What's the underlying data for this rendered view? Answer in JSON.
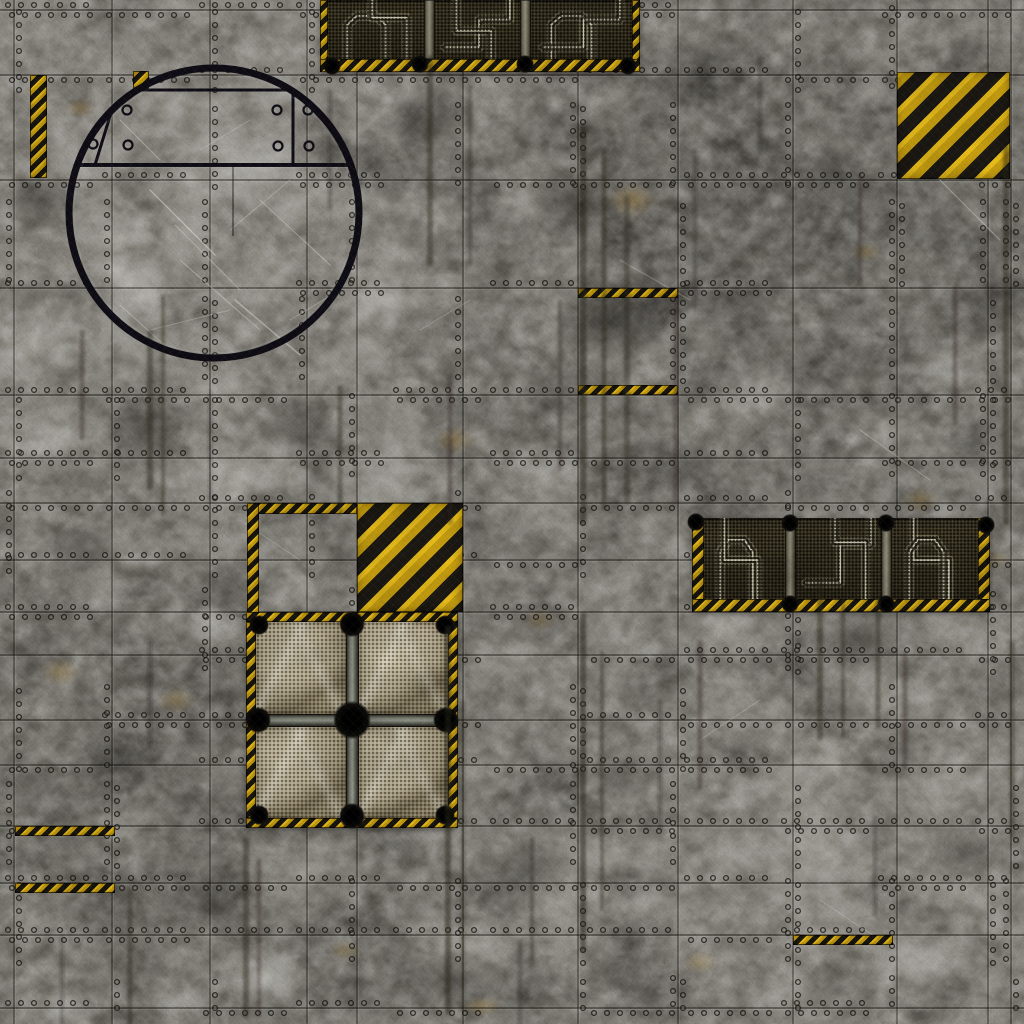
{
  "scene": {
    "type": "sci-fi-industrial-floor-battle-mat",
    "size": 1024
  },
  "palette": {
    "floor_mid": "#8e8b83",
    "floor_light": "#cbc8c0",
    "floor_dark": "#403e39",
    "seam": "#14120e",
    "seam_highlight": "rgba(255,255,255,0.13)",
    "rivet_fill": "rgba(180,177,168,0.15)",
    "rivet_ring": "#0f0d0a",
    "hazard_yellow_bright": "#f0bd17",
    "hazard_yellow": "#c9990e",
    "hazard_black": "#191611",
    "vent_bg_light": "#3a3420",
    "vent_bg_dark": "#201b10",
    "pipe_halo": "rgba(225,218,185,0.25)",
    "pipe_dark": "rgba(26,22,12,0.85)",
    "pipe_bright": "rgba(236,230,200,0.85)",
    "mesh_tan_light": "#d2c8ab",
    "mesh_tan": "#b5aa8d",
    "mesh_tan_dark": "#6f654d",
    "metal_bar_light": "#8d897a",
    "metal_bar_dark": "#17140c",
    "blob_black": "#0a0907",
    "hatch_ring": "#0d0b13",
    "scratch": "#efede6",
    "streak": "#262218",
    "rust": "#966e1e"
  },
  "seams": {
    "verticals": [
      14,
      112,
      210,
      307,
      357,
      463,
      578,
      678,
      793,
      897,
      988,
      1011
    ],
    "horizontals": [
      10,
      75,
      180,
      288,
      395,
      458,
      503,
      560,
      612,
      655,
      720,
      765,
      826,
      883,
      935,
      1008
    ]
  },
  "rivet_params": {
    "seed": 99,
    "step": 13,
    "radius": 2.4,
    "block": 97,
    "prob_h": 0.45,
    "prob_v": 0.32
  },
  "streaks": [
    [
      150,
      330,
      160,
      6,
      0.45
    ],
    [
      163,
      295,
      220,
      4,
      0.4
    ],
    [
      82,
      330,
      110,
      5,
      0.35
    ],
    [
      340,
      385,
      130,
      5,
      0.4
    ],
    [
      430,
      55,
      210,
      6,
      0.45
    ],
    [
      470,
      85,
      180,
      4,
      0.35
    ],
    [
      583,
      125,
      400,
      7,
      0.5
    ],
    [
      604,
      150,
      360,
      5,
      0.45
    ],
    [
      627,
      195,
      310,
      6,
      0.4
    ],
    [
      560,
      300,
      170,
      4,
      0.35
    ],
    [
      450,
      375,
      150,
      5,
      0.35
    ],
    [
      448,
      625,
      390,
      6,
      0.5
    ],
    [
      463,
      700,
      310,
      4,
      0.4
    ],
    [
      583,
      612,
      340,
      6,
      0.5
    ],
    [
      602,
      650,
      260,
      4,
      0.4
    ],
    [
      700,
      640,
      150,
      5,
      0.35
    ],
    [
      820,
      580,
      160,
      6,
      0.45
    ],
    [
      843,
      598,
      140,
      4,
      0.4
    ],
    [
      878,
      598,
      130,
      5,
      0.4
    ],
    [
      955,
      285,
      140,
      5,
      0.35
    ],
    [
      1006,
      145,
      380,
      6,
      0.45
    ],
    [
      246,
      838,
      180,
      6,
      0.45
    ],
    [
      259,
      858,
      160,
      4,
      0.35
    ],
    [
      130,
      888,
      140,
      5,
      0.4
    ],
    [
      532,
      838,
      130,
      4,
      0.35
    ],
    [
      660,
      700,
      130,
      4,
      0.3
    ],
    [
      760,
      55,
      100,
      4,
      0.3
    ],
    [
      860,
      175,
      110,
      4,
      0.35
    ],
    [
      676,
      295,
      210,
      5,
      0.35
    ],
    [
      695,
      148,
      160,
      4,
      0.3
    ],
    [
      62,
      935,
      90,
      4,
      0.3
    ],
    [
      905,
      650,
      120,
      5,
      0.35
    ],
    [
      1012,
      640,
      200,
      5,
      0.4
    ],
    [
      330,
      90,
      120,
      4,
      0.3
    ],
    [
      210,
      390,
      110,
      4,
      0.3
    ],
    [
      520,
      940,
      90,
      4,
      0.3
    ],
    [
      875,
      815,
      100,
      4,
      0.3
    ],
    [
      150,
      640,
      110,
      4,
      0.3
    ]
  ],
  "patches": {
    "dark": [
      [
        430,
        120,
        70,
        50,
        0.4
      ],
      [
        610,
        320,
        85,
        60,
        0.45
      ],
      [
        860,
        640,
        70,
        50,
        0.4
      ],
      [
        520,
        880,
        80,
        60,
        0.35
      ],
      [
        150,
        430,
        70,
        55,
        0.4
      ],
      [
        40,
        200,
        55,
        45,
        0.35
      ],
      [
        990,
        300,
        55,
        60,
        0.35
      ],
      [
        700,
        80,
        60,
        40,
        0.35
      ],
      [
        300,
        430,
        60,
        45,
        0.35
      ],
      [
        830,
        170,
        50,
        40,
        0.3
      ],
      [
        570,
        200,
        70,
        50,
        0.4
      ],
      [
        460,
        980,
        70,
        45,
        0.35
      ],
      [
        120,
        760,
        60,
        45,
        0.3
      ],
      [
        680,
        470,
        60,
        40,
        0.35
      ],
      [
        960,
        850,
        60,
        50,
        0.3
      ],
      [
        210,
        900,
        70,
        50,
        0.3
      ],
      [
        620,
        770,
        60,
        45,
        0.3
      ],
      [
        80,
        545,
        55,
        40,
        0.3
      ]
    ],
    "light": [
      [
        250,
        170,
        80,
        60,
        0.35
      ],
      [
        130,
        285,
        60,
        45,
        0.4
      ],
      [
        545,
        470,
        55,
        40,
        0.35
      ],
      [
        265,
        975,
        65,
        45,
        0.4
      ],
      [
        645,
        905,
        55,
        40,
        0.35
      ],
      [
        940,
        365,
        50,
        40,
        0.35
      ],
      [
        762,
        390,
        55,
        40,
        0.3
      ],
      [
        100,
        592,
        45,
        35,
        0.3
      ],
      [
        520,
        205,
        50,
        35,
        0.25
      ],
      [
        208,
        625,
        50,
        35,
        0.3
      ],
      [
        925,
        955,
        55,
        40,
        0.35
      ],
      [
        55,
        445,
        40,
        30,
        0.3
      ],
      [
        990,
        480,
        45,
        40,
        0.3
      ],
      [
        175,
        1005,
        50,
        30,
        0.3
      ],
      [
        740,
        855,
        50,
        35,
        0.3
      ],
      [
        380,
        300,
        55,
        40,
        0.25
      ],
      [
        870,
        90,
        45,
        30,
        0.25
      ],
      [
        60,
        1010,
        45,
        25,
        0.3
      ]
    ],
    "rust": [
      [
        632,
        200,
        35,
        25,
        0.35
      ],
      [
        455,
        440,
        28,
        20,
        0.35
      ],
      [
        60,
        672,
        28,
        20,
        0.3
      ],
      [
        920,
        500,
        26,
        18,
        0.3
      ],
      [
        176,
        700,
        28,
        18,
        0.3
      ],
      [
        700,
        962,
        24,
        16,
        0.3
      ],
      [
        482,
        1006,
        28,
        14,
        0.35
      ],
      [
        866,
        252,
        22,
        14,
        0.3
      ],
      [
        540,
        620,
        24,
        16,
        0.25
      ],
      [
        80,
        108,
        22,
        14,
        0.3
      ],
      [
        345,
        950,
        24,
        14,
        0.25
      ],
      [
        995,
        560,
        22,
        14,
        0.25
      ]
    ]
  },
  "scratches": [
    [
      150,
      190,
      215,
      255,
      1.5,
      0.5
    ],
    [
      235,
      300,
      300,
      355,
      1.5,
      0.45
    ],
    [
      180,
      260,
      260,
      330,
      1,
      0.4
    ],
    [
      120,
      305,
      170,
      350,
      1,
      0.35
    ],
    [
      260,
      200,
      330,
      265,
      1,
      0.4
    ],
    [
      200,
      150,
      250,
      120,
      1,
      0.3
    ],
    [
      290,
      320,
      340,
      290,
      1,
      0.35
    ],
    [
      150,
      330,
      230,
      310,
      1,
      0.3
    ],
    [
      940,
      180,
      1000,
      240,
      1.2,
      0.4
    ],
    [
      860,
      430,
      930,
      480,
      1,
      0.3
    ],
    [
      620,
      260,
      690,
      300,
      1,
      0.3
    ],
    [
      700,
      740,
      760,
      700,
      1,
      0.25
    ],
    [
      240,
      520,
      300,
      560,
      1,
      0.25
    ],
    [
      820,
      900,
      880,
      940,
      1,
      0.3
    ],
    [
      120,
      120,
      160,
      160,
      1.2,
      0.4
    ],
    [
      420,
      330,
      470,
      300,
      1,
      0.25
    ],
    [
      230,
      230,
      290,
      180,
      1,
      0.35
    ],
    [
      175,
      225,
      240,
      290,
      1,
      0.4
    ]
  ],
  "features": {
    "hatch": {
      "cx": 214,
      "cy": 213,
      "r": 145,
      "ring_w": 7,
      "chord_y": 165,
      "plate_top_y": 90,
      "plate_right_x": 293,
      "plate_left_top_x": 118,
      "plate_left_bot_x": 95,
      "inner_line": [
        233,
        165,
        236
      ],
      "rivets": [
        [
          127,
          110
        ],
        [
          277,
          110
        ],
        [
          308,
          110
        ],
        [
          93,
          144
        ],
        [
          128,
          145
        ],
        [
          278,
          146
        ],
        [
          309,
          146
        ]
      ]
    },
    "top_vents": {
      "x": 320,
      "y": 0,
      "w": 320,
      "h": 72,
      "hazard_h": 13,
      "side_w": 8,
      "posts": [
        104,
        200
      ],
      "post_w": 11,
      "blobs": [
        [
          100,
          64
        ],
        [
          205,
          64
        ],
        [
          12,
          66
        ],
        [
          308,
          66
        ]
      ],
      "pipe_sets": [
        [
          "a",
          "d"
        ],
        [
          "b",
          "c"
        ],
        [
          "a",
          "b"
        ]
      ]
    },
    "right_vents": {
      "x": 692,
      "y": 518,
      "w": 298,
      "h": 94,
      "hazard_h": 13,
      "side_w": 12,
      "posts": [
        93,
        189
      ],
      "post_w": 11,
      "blobs": [
        [
          4,
          4
        ],
        [
          98,
          5
        ],
        [
          194,
          5
        ],
        [
          294,
          7
        ],
        [
          98,
          86
        ],
        [
          194,
          86
        ]
      ],
      "pipe_sets": [
        [
          "a",
          "c"
        ],
        [
          "b",
          "d"
        ],
        [
          "c",
          "a"
        ]
      ]
    },
    "pipe_lib": {
      "a": [
        [
          0.2,
          1.08
        ],
        [
          0.2,
          0.42
        ],
        [
          0.3,
          0.27
        ],
        [
          0.5,
          0.27
        ],
        [
          0.6,
          0.42
        ],
        [
          0.6,
          1.08
        ]
      ],
      "b": [
        [
          0.12,
          0.8
        ],
        [
          0.52,
          0.8
        ],
        [
          0.52,
          0.33
        ],
        [
          0.88,
          0.33
        ],
        [
          0.88,
          -0.08
        ]
      ],
      "c": [
        [
          0.25,
          -0.08
        ],
        [
          0.25,
          0.52
        ],
        [
          0.66,
          0.52
        ],
        [
          0.66,
          1.08
        ]
      ],
      "d": [
        [
          0.82,
          1.08
        ],
        [
          0.82,
          0.3
        ],
        [
          0.46,
          0.3
        ],
        [
          0.46,
          -0.08
        ]
      ]
    },
    "tr_square": {
      "x": 897,
      "y": 72,
      "w": 113,
      "h": 107
    },
    "center_square": {
      "x": 357,
      "y": 503,
      "w": 106,
      "h": 109
    },
    "fan": {
      "x": 246,
      "y": 612,
      "w": 212,
      "h": 216,
      "border": 10,
      "bar_w": 13,
      "blob_r_center": 19,
      "blob_r_mid": 13,
      "blob_r_corner": 10
    },
    "strips": [
      {
        "name": "hazard-strip-mid-upper",
        "x": 578,
        "y": 288,
        "w": 100,
        "h": 10
      },
      {
        "name": "hazard-strip-mid-lower",
        "x": 578,
        "y": 385,
        "w": 100,
        "h": 10
      },
      {
        "name": "hazard-strip-bottom-left-upper",
        "x": 15,
        "y": 826,
        "w": 100,
        "h": 10
      },
      {
        "name": "hazard-strip-bottom-left-lower",
        "x": 15,
        "y": 883,
        "w": 100,
        "h": 10
      },
      {
        "name": "hazard-strip-bottom-right",
        "x": 793,
        "y": 935,
        "w": 100,
        "h": 10
      },
      {
        "name": "hazard-strip-top-left-vertical",
        "x": 30,
        "y": 75,
        "w": 17,
        "h": 103
      },
      {
        "name": "hazard-strip-circle-fragment",
        "x": 133,
        "y": 71,
        "w": 16,
        "h": 18
      },
      {
        "name": "hazard-strip-center-top",
        "x": 247,
        "y": 503,
        "w": 110,
        "h": 11
      },
      {
        "name": "hazard-strip-center-left-vertical",
        "x": 247,
        "y": 503,
        "w": 12,
        "h": 110
      }
    ]
  }
}
